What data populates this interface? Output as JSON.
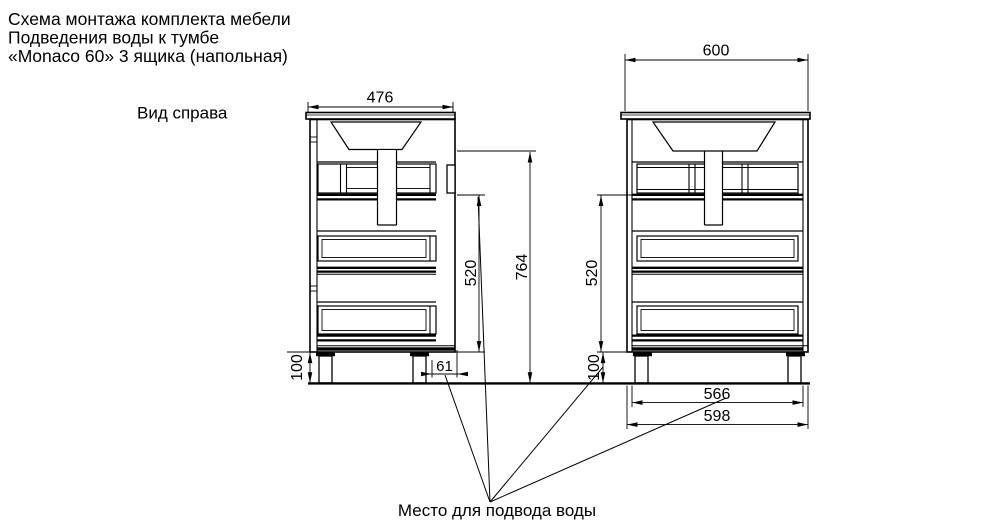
{
  "title": {
    "line1": "Схема монтажа комплекта мебели",
    "line2": "Подведения воды к тумбе",
    "line3": "«Monaco 60» 3 ящика (напольная)"
  },
  "labels": {
    "view_right": "Вид справа",
    "water_note": "Место для подвода воды"
  },
  "dimensions": {
    "countertop_depth": "476",
    "countertop_width": "600",
    "total_height": "764",
    "cabinet_height_side": "520",
    "cabinet_height_front": "520",
    "legs_height_side": "100",
    "legs_height_front": "100",
    "water_offset": "61",
    "legs_outer_span": "566",
    "base_width": "598"
  },
  "colors": {
    "line": "#000000",
    "background": "#ffffff"
  }
}
